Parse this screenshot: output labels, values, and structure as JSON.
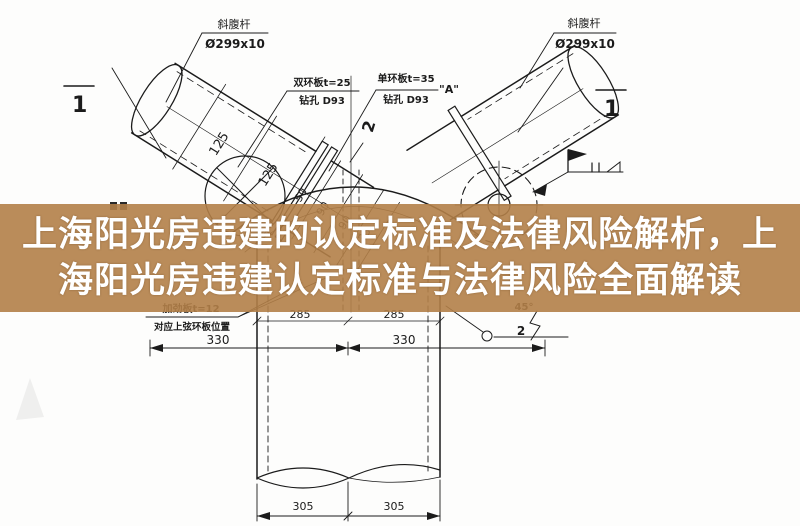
{
  "overlay": {
    "title_line1": "上海阳光房违建的认定标准及法律风险解析，上",
    "title_line2": "海阳光房违建认定标准与法律风险全面解读",
    "band_rgba": "rgba(178,128,72,0.9)",
    "band_color_hex": "#B2804A",
    "text_color": "#FFFFFF"
  },
  "drawing": {
    "line_color": "#1b1b1b",
    "callouts": {
      "left_pipe": {
        "name": "斜腹杆",
        "spec": "Ø299x10"
      },
      "right_pipe": {
        "name": "斜腹杆",
        "spec": "Ø299x10"
      },
      "double_ring": {
        "line1": "双环板t=25",
        "line2": "钻孔 D93"
      },
      "single_ring": {
        "line1": "单环板t=35",
        "line2": "钻孔 D93",
        "detail": "\"A\""
      },
      "stiffener": {
        "line1": "加劲板t=12",
        "line2": "对应上弦环板位置"
      },
      "angle": "45°"
    },
    "section_marks": {
      "s1": "1",
      "s2": "2"
    },
    "dims": {
      "pipe": [
        "125",
        "125",
        "50",
        "90",
        "90",
        "35"
      ],
      "row_285": [
        "285",
        "285"
      ],
      "row_330": [
        "330",
        "330"
      ],
      "row_305": [
        "305",
        "305"
      ]
    }
  }
}
